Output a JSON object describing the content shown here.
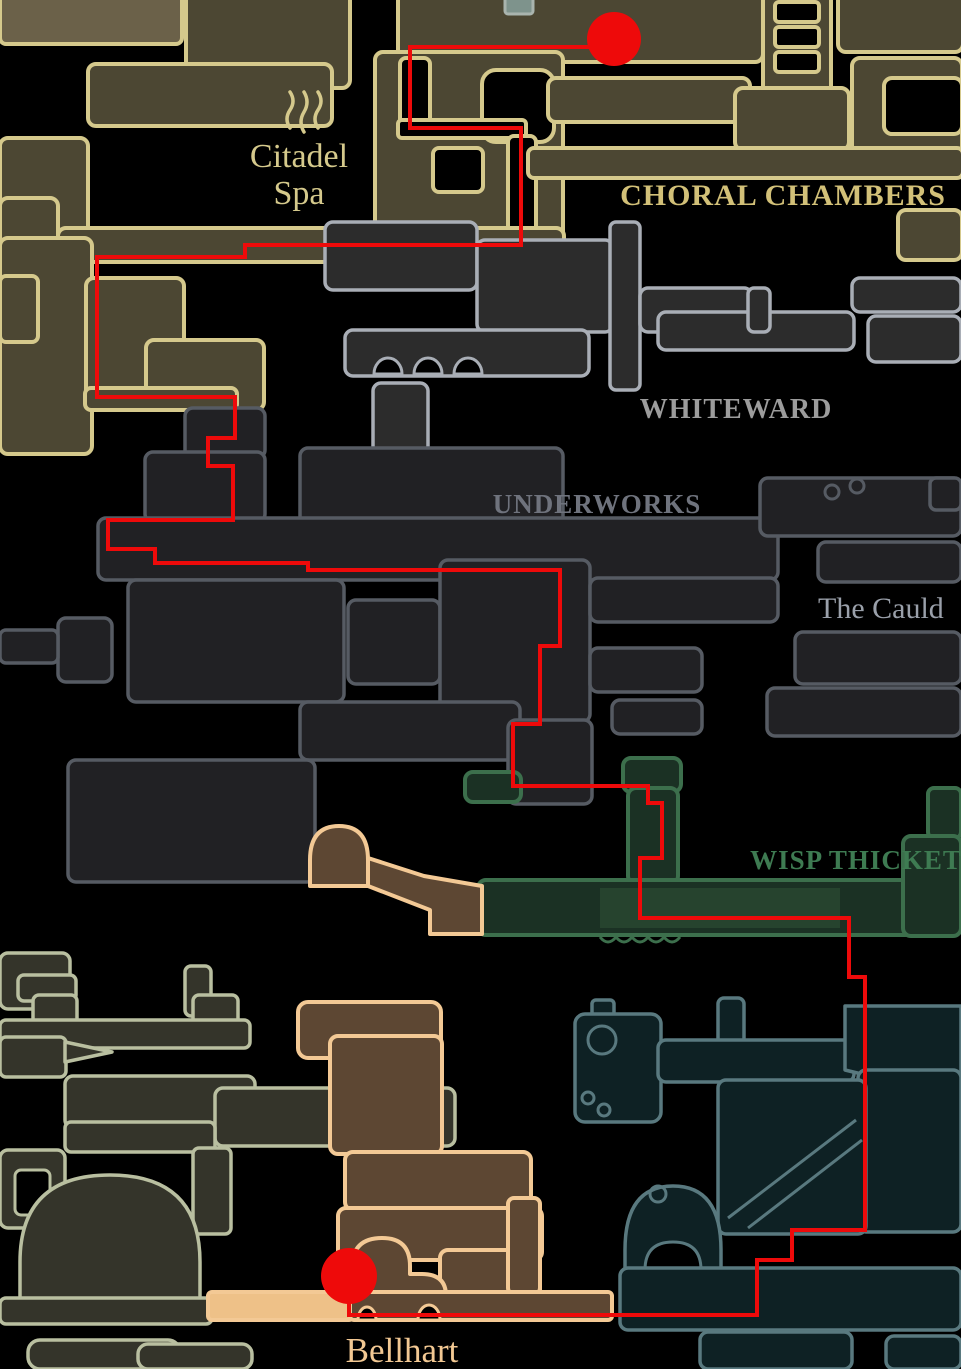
{
  "colors": {
    "background": "#000000",
    "olive_outline": "#d5c98c",
    "olive_fill": "#4c4733",
    "olive_fill_light": "#6b6149",
    "whiteward_outline": "#a9aeb6",
    "whiteward_fill": "#2c2c2c",
    "underworks_outline": "#565b63",
    "underworks_fill": "#212124",
    "wisp_outline": "#3c6f4c",
    "wisp_fill": "#1b3124",
    "wisp_room_fill": "#26432e",
    "peach_outline": "#f3c995",
    "peach_fill": "#5d4733",
    "peach_floor_fill": "#eec188",
    "teal_outline": "#59797f",
    "teal_fill": "#0e2124",
    "sage_outline": "#b9bfa0",
    "sage_fill": "#34342a"
  },
  "regions": {
    "citadel_spa": {
      "label_line1": "Citadel",
      "label_line2": "Spa",
      "label_color": "#d5c98c"
    },
    "choral_chambers": {
      "label": "CHORAL CHAMBERS",
      "label_color": "#d2c078"
    },
    "whiteward": {
      "label": "WHITEWARD",
      "label_color": "#9c9c9c"
    },
    "underworks": {
      "label": "UNDERWORKS",
      "label_color": "#6f737d"
    },
    "the_cauldron": {
      "label": "The Cauld",
      "label_color": "#9aa0aa"
    },
    "wisp_thicket": {
      "label": "WISP THICKET",
      "label_color": "#3e7b52"
    },
    "bellhart": {
      "label": "Bellhart",
      "label_color": "#f2c893"
    }
  },
  "route": {
    "color": "#ee0a0a",
    "stroke_width": 10,
    "points": [
      [
        614,
        47
      ],
      [
        410,
        47
      ],
      [
        410,
        128
      ],
      [
        521,
        128
      ],
      [
        521,
        245
      ],
      [
        245,
        245
      ],
      [
        245,
        257
      ],
      [
        97,
        257
      ],
      [
        97,
        397
      ],
      [
        235,
        397
      ],
      [
        235,
        438
      ],
      [
        208,
        438
      ],
      [
        208,
        466
      ],
      [
        233,
        466
      ],
      [
        233,
        520
      ],
      [
        108,
        520
      ],
      [
        108,
        549
      ],
      [
        155,
        549
      ],
      [
        155,
        563
      ],
      [
        308,
        563
      ],
      [
        308,
        570
      ],
      [
        560,
        570
      ],
      [
        560,
        646
      ],
      [
        540,
        646
      ],
      [
        540,
        724
      ],
      [
        513,
        724
      ],
      [
        513,
        786
      ],
      [
        648,
        786
      ],
      [
        648,
        803
      ],
      [
        662,
        803
      ],
      [
        662,
        858
      ],
      [
        640,
        858
      ],
      [
        640,
        918
      ],
      [
        849,
        918
      ],
      [
        849,
        977
      ],
      [
        865,
        977
      ],
      [
        865,
        1230
      ],
      [
        792,
        1230
      ],
      [
        792,
        1260
      ],
      [
        757,
        1260
      ],
      [
        757,
        1315
      ],
      [
        349,
        1315
      ],
      [
        349,
        1277
      ]
    ],
    "start_marker": {
      "cx": 614,
      "cy": 39,
      "r": 27
    },
    "end_marker": {
      "cx": 349,
      "cy": 1276,
      "r": 28
    }
  },
  "icons": [
    {
      "name": "spa-steam-icon"
    },
    {
      "name": "route-start-marker"
    },
    {
      "name": "route-end-marker"
    }
  ]
}
